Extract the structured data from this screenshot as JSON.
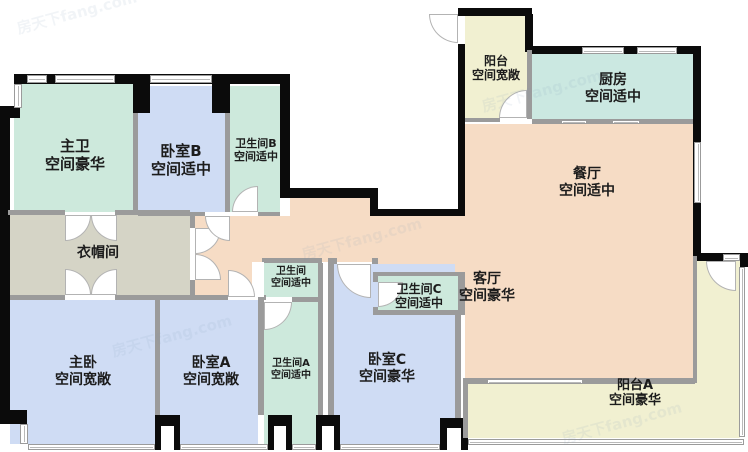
{
  "watermark": {
    "text": "房天下fang.com"
  },
  "colors": {
    "bath_mint": "#cde9dc",
    "bedroom_blue": "#cfdcf4",
    "public_peach": "#f6dcc5",
    "balcony_yellow": "#f1f0d1",
    "kitchen_teal": "#cbe8e1",
    "closet_beige": "#d5d4c6",
    "wall_black": "#0b0b0b",
    "wall_gray": "#9b9b9b"
  },
  "rooms": [
    {
      "id": "master-bath",
      "name": "主卫",
      "desc": "空间豪华"
    },
    {
      "id": "bedroom-b",
      "name": "卧室B",
      "desc": "空间适中"
    },
    {
      "id": "bath-b",
      "name": "卫生间B",
      "desc": "空间适中"
    },
    {
      "id": "balcony",
      "name": "阳台",
      "desc": "空间宽敞"
    },
    {
      "id": "kitchen",
      "name": "厨房",
      "desc": "空间适中"
    },
    {
      "id": "dining",
      "name": "餐厅",
      "desc": "空间适中"
    },
    {
      "id": "cloakroom",
      "name": "衣帽间",
      "desc": ""
    },
    {
      "id": "master-bedroom",
      "name": "主卧",
      "desc": "空间宽敞"
    },
    {
      "id": "bedroom-a",
      "name": "卧室A",
      "desc": "空间宽敞"
    },
    {
      "id": "bath",
      "name": "卫生间",
      "desc": "空间适中"
    },
    {
      "id": "bath-a",
      "name": "卫生间A",
      "desc": "空间适中"
    },
    {
      "id": "bedroom-c",
      "name": "卧室C",
      "desc": "空间豪华"
    },
    {
      "id": "bath-c",
      "name": "卫生间C",
      "desc": "空间适中"
    },
    {
      "id": "living",
      "name": "客厅",
      "desc": "空间豪华"
    },
    {
      "id": "balcony-a",
      "name": "阳台A",
      "desc": "空间豪华"
    }
  ]
}
